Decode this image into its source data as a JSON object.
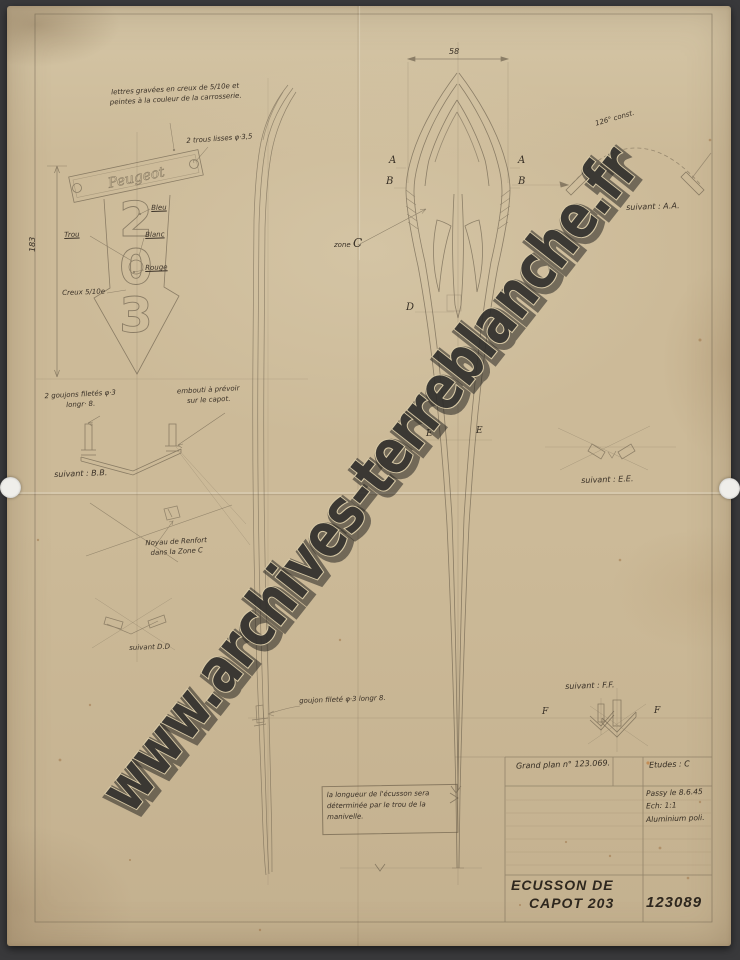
{
  "document": {
    "watermark": "www.archives-terreblanche.fr",
    "colors": {
      "paper": "#ccba98",
      "ink": "#3a3127",
      "pencil": "#5e5342",
      "scan_background": "#39393b",
      "watermark": "#2c2b29"
    },
    "badge": {
      "script": "Peugeot",
      "digits": [
        "2",
        "0",
        "3"
      ]
    },
    "annotations": {
      "engraving_1": "lettres gravées en creux de 5/10e et",
      "engraving_2": "peintes à la couleur de la carrosserie.",
      "holes": "2 trous lisses φ·3,5",
      "bleu": "Bleu",
      "trou": "Trou",
      "blanc": "Blanc",
      "rouge": "Rouge",
      "creux": "Creux 5/10e",
      "goujons_1": "2 goujons filetés φ·3",
      "goujons_2": "longr· 8.",
      "embouti_1": "embouti à prévoir",
      "embouti_2": "sur le capot.",
      "noyau_1": "Noyau de Renfort",
      "noyau_2": "dans la Zone C",
      "goujon_filete": "goujon fileté φ·3  longr 8.",
      "length_1": "la longueur de l'écusson sera",
      "length_2": "déterminée par le trou de la",
      "length_3": "manivelle.",
      "angle": "126° const.",
      "zone": "zone"
    },
    "sections": {
      "aa": "suivant : A.A.",
      "bb": "suivant : B.B.",
      "dd": "suivant  D.D",
      "ee": "suivant : E.E.",
      "ff": "suivant : F.F."
    },
    "markers": {
      "a": "A",
      "b": "B",
      "c": "C",
      "d": "D",
      "e": "E",
      "f": "F"
    },
    "dimensions": {
      "width": "58",
      "height": "183"
    },
    "title_block": {
      "grand_plan": "Grand plan n° 123.069.",
      "etudes": "Etudes : C",
      "place_date": "Passy le 8.6.45",
      "scale": "Ech:  1:1",
      "material": "Aluminium poli.",
      "title_1": "ECUSSON DE",
      "title_2": "CAPOT 203",
      "number": "123089"
    }
  }
}
